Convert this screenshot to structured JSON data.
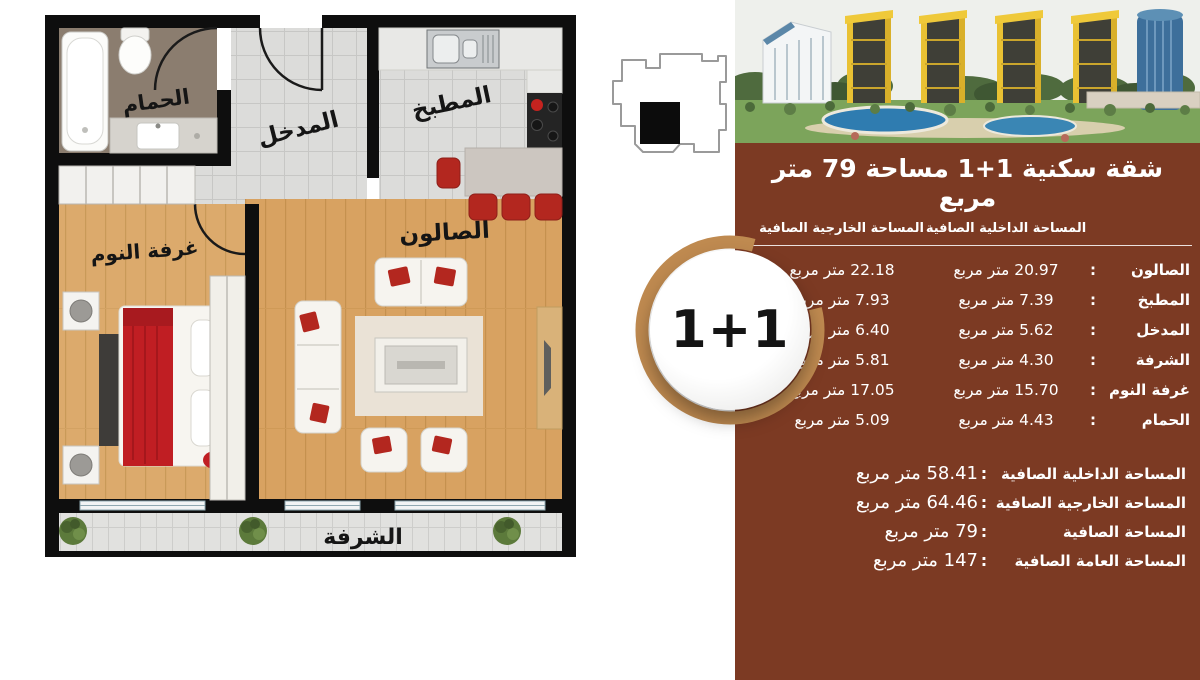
{
  "plan": {
    "rooms": {
      "bathroom": "الحمام",
      "entrance": "المدخل",
      "kitchen": "المطبخ",
      "living": "الصالون",
      "bedroom": "غرفة النوم",
      "balcony": "الشرفة"
    }
  },
  "panel": {
    "title": "شقة سكنية  1+1  مساحة  79 متر مربع",
    "columns": {
      "internal": "المساحة الداخلية الصافية",
      "external": "المساحة الخارجية الصافية"
    },
    "separator": ":",
    "rows": [
      {
        "label": "الصالون",
        "internal": "20.97 متر مربع",
        "external": "22.18 متر مربع"
      },
      {
        "label": "المطبخ",
        "internal": "7.39 متر مربع",
        "external": "7.93 متر مربع"
      },
      {
        "label": "المدخل",
        "internal": "5.62 متر مربع",
        "external": "6.40 متر مربع"
      },
      {
        "label": "الشرفة",
        "internal": "4.30 متر مربع",
        "external": "5.81 متر مربع"
      },
      {
        "label": "غرفة النوم",
        "internal": "15.70 متر مربع",
        "external": "17.05 متر مربع"
      },
      {
        "label": "الحمام",
        "internal": "4.43 متر مربع",
        "external": "5.09 متر مربع"
      }
    ],
    "summary": [
      {
        "label": "المساحة الداخلية الصافية",
        "value": "58.41 متر مربع"
      },
      {
        "label": "المساحة الخارجية الصافية",
        "value": "64.46 متر مربع"
      },
      {
        "label": "المساحة الصافية",
        "value": "79 متر مربع"
      },
      {
        "label": "المساحة العامة الصافية",
        "value": "147 متر مربع"
      }
    ],
    "badge": "1+1"
  },
  "colors": {
    "panel_bg": "#7C3A23",
    "badge_ring": "#BF8A50",
    "accent_red": "#B3271F",
    "wall_black": "#0E0E0E",
    "wood_floor": "#D8A261",
    "keyplan_marker": "#0C0C0C"
  }
}
